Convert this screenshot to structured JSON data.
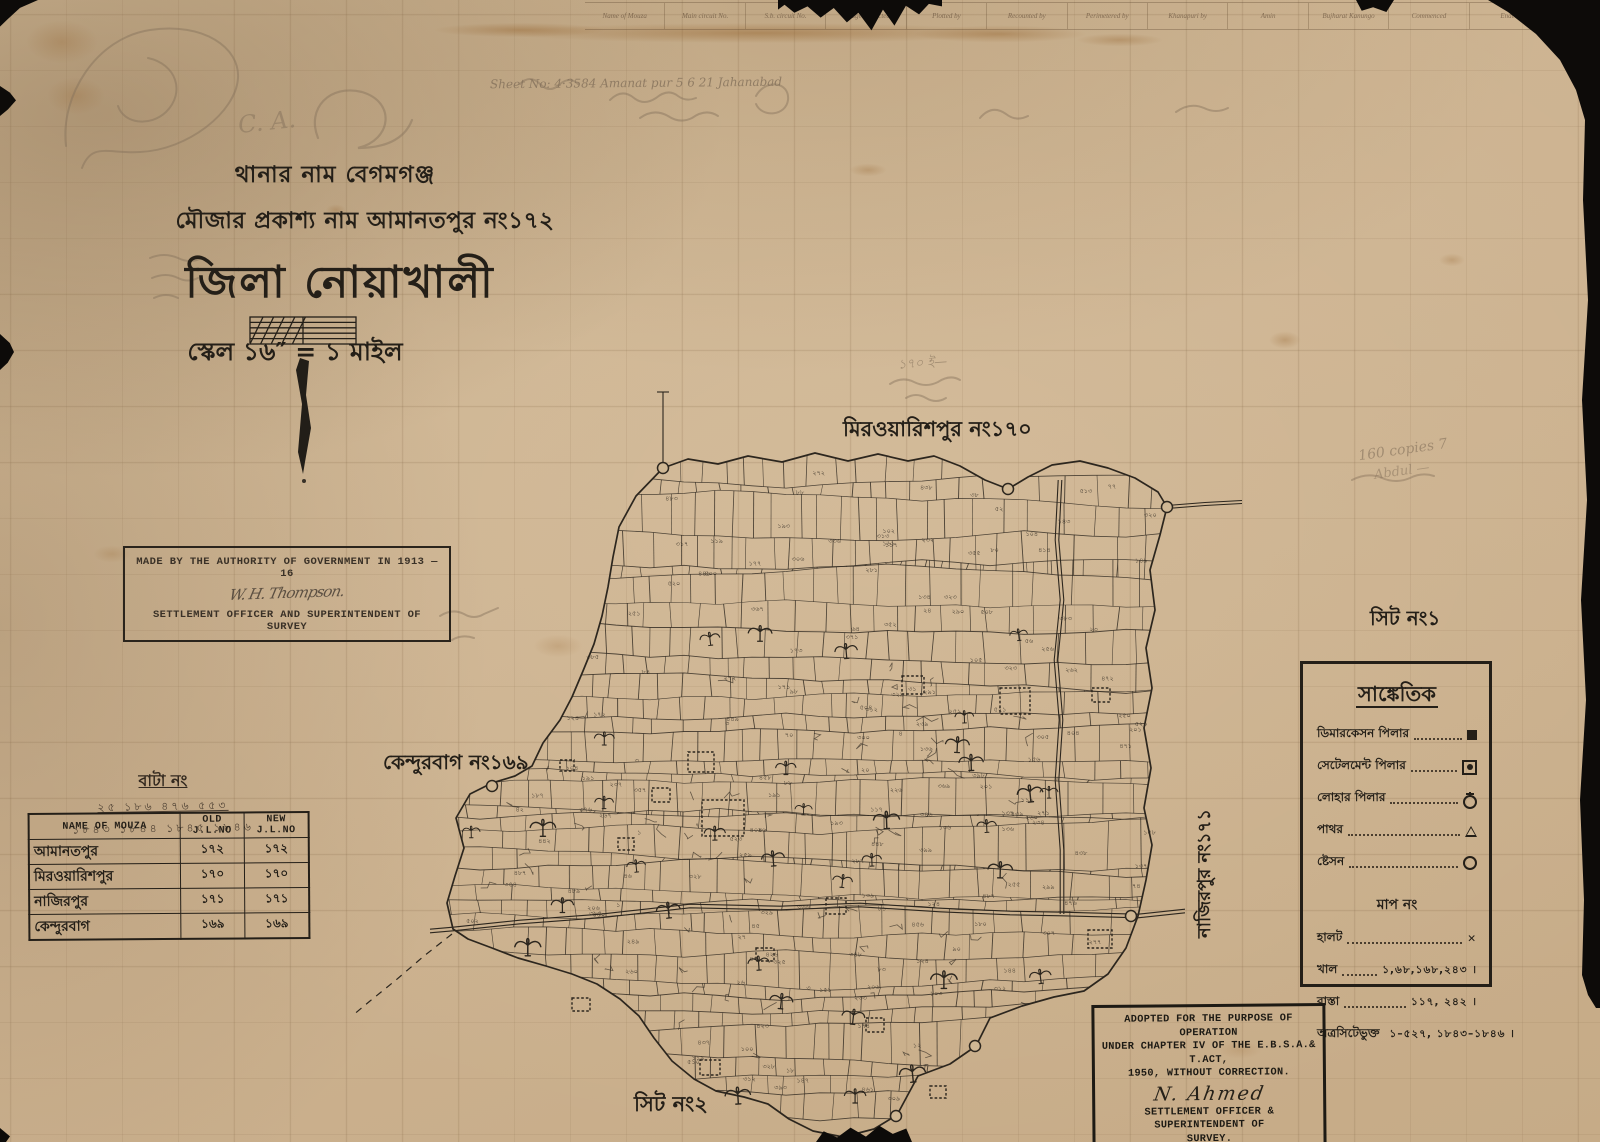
{
  "header_strip": {
    "columns": [
      "Name of Mouza",
      "Main circuit No.",
      "S.b. circuit No.",
      "Village inspected",
      "Plotted by",
      "Recounted by",
      "Perimetered by",
      "Khanapuri by",
      "Amin",
      "Bujharat Kanungo",
      "Commenced",
      "Ended"
    ]
  },
  "title_block": {
    "line1": "থানার নাম বেগমগঞ্জ",
    "line2": "মৌজার প্রকাশ্য নাম আমানতপুর নং১৭২",
    "line3": "জিলা নোয়াখালী",
    "line4": "স্কেল ১৬″ = ১ মাইল"
  },
  "authority_box": {
    "line1": "MADE BY THE AUTHORITY OF GOVERNMENT IN 1913 — 16",
    "signature": "W. H. Thompson.",
    "line2": "SETTLEMENT OFFICER AND SUPERINTENDENT OF SURVEY"
  },
  "bata_block": {
    "title": "বাটা নং",
    "row1": "২৫  ১৮৬  ৪৭৬  ৫৫৩",
    "row2": "১৮৪৩ ১৮৪৪ ১৮৪৫ ১৮৪৬"
  },
  "mouza_table": {
    "headers": [
      "NAME OF MOUZA",
      "OLD J.L.NO",
      "NEW J.L.NO"
    ],
    "rows": [
      [
        "আমানতপুর",
        "১৭২",
        "১৭২"
      ],
      [
        "মিরওয়ারিশপুর",
        "১৭০",
        "১৭০"
      ],
      [
        "নাজিরপুর",
        "১৭১",
        "১৭১"
      ],
      [
        "কেন্দুরবাগ",
        "১৬৯",
        "১৬৯"
      ]
    ]
  },
  "map_labels": {
    "north_neighbor": "মিরওয়ারিশপুর নং১৭০",
    "west_neighbor": "কেন্দুরবাগ নং১৬৯",
    "east_neighbor": "নাজিরপুর নং১৭১",
    "sheet1": "সিট নং১",
    "sheet2": "সিট নং২"
  },
  "legend": {
    "title": "সাঙ্কেতিক",
    "pillar_rows": [
      {
        "label": "ডিমারকেসন পিলার",
        "symbol": "sq-filled"
      },
      {
        "label": "সেটেলমেন্ট পিলার",
        "symbol": "sq-dot"
      },
      {
        "label": "লোহার পিলার",
        "symbol": "circle-cross"
      },
      {
        "label": "পাথর",
        "symbol": "triangle"
      },
      {
        "label": "ষ্টেসন",
        "symbol": "circle"
      }
    ],
    "subtitle": "মাপ নং",
    "number_rows": [
      {
        "label": "হালট",
        "value": "✕"
      },
      {
        "label": "খাল",
        "value": "১,৬৮,১৬৮,২৪৩ ।"
      },
      {
        "label": "রাস্তা",
        "value": "১১৭, ২৪২ ।"
      },
      {
        "label": "অত্রসিটেভুক্ত",
        "value": "১–৫২৭, ১৮৪৩–১৮৪৬ ।"
      }
    ]
  },
  "stamp": {
    "line1": "ADOPTED FOR THE PURPOSE OF OPERATION",
    "line2": "UNDER CHAPTER IV OF THE E.B.S.A.& T.ACT,",
    "line3": "1950, WITHOUT CORRECTION.",
    "signature": "N. Ahmed",
    "line4": "SETTLEMENT OFFICER & SUPERINTENDENT OF",
    "line5": "SURVEY."
  },
  "pencil_annotations": [
    {
      "text": "Sheet No:   4·3584    Amanat pur          5              6            21       Jahanabad",
      "x": 490,
      "y": 76,
      "size": 12,
      "rot": -0.5,
      "op": 0.8
    },
    {
      "text": "C. A.",
      "x": 238,
      "y": 108,
      "size": 24,
      "rot": -6,
      "op": 0.5
    },
    {
      "text": "১৭০ ই—",
      "x": 898,
      "y": 354,
      "size": 13,
      "rot": -4,
      "op": 0.6
    },
    {
      "text": "160 copies 7",
      "x": 1358,
      "y": 442,
      "size": 14,
      "rot": -8,
      "op": 0.6
    },
    {
      "text": "Abdul —",
      "x": 1374,
      "y": 464,
      "size": 13,
      "rot": -8,
      "op": 0.5
    }
  ],
  "colors": {
    "paper": "#cfb794",
    "ink": "#2c261e",
    "pencil": "#84715b",
    "stamp_ink": "#1d1a14"
  },
  "map_render": {
    "seed": 7,
    "boundary": [
      [
        663,
        468
      ],
      [
        688,
        459
      ],
      [
        718,
        464
      ],
      [
        748,
        456
      ],
      [
        782,
        462
      ],
      [
        815,
        453
      ],
      [
        848,
        461
      ],
      [
        878,
        454
      ],
      [
        908,
        461
      ],
      [
        934,
        456
      ],
      [
        960,
        466
      ],
      [
        985,
        480
      ],
      [
        1008,
        489
      ],
      [
        1028,
        477
      ],
      [
        1052,
        465
      ],
      [
        1080,
        461
      ],
      [
        1108,
        468
      ],
      [
        1135,
        478
      ],
      [
        1158,
        492
      ],
      [
        1167,
        507
      ],
      [
        1160,
        535
      ],
      [
        1150,
        570
      ],
      [
        1155,
        610
      ],
      [
        1146,
        648
      ],
      [
        1152,
        688
      ],
      [
        1144,
        728
      ],
      [
        1151,
        768
      ],
      [
        1144,
        808
      ],
      [
        1152,
        845
      ],
      [
        1146,
        880
      ],
      [
        1138,
        916
      ],
      [
        1126,
        948
      ],
      [
        1108,
        974
      ],
      [
        1084,
        991
      ],
      [
        1054,
        997
      ],
      [
        1022,
        1006
      ],
      [
        990,
        1018
      ],
      [
        976,
        1046
      ],
      [
        950,
        1064
      ],
      [
        918,
        1076
      ],
      [
        897,
        1115
      ],
      [
        874,
        1129
      ],
      [
        843,
        1137
      ],
      [
        813,
        1131
      ],
      [
        789,
        1119
      ],
      [
        768,
        1104
      ],
      [
        744,
        1097
      ],
      [
        716,
        1091
      ],
      [
        694,
        1079
      ],
      [
        672,
        1061
      ],
      [
        654,
        1038
      ],
      [
        639,
        1016
      ],
      [
        620,
        999
      ],
      [
        597,
        984
      ],
      [
        572,
        974
      ],
      [
        546,
        966
      ],
      [
        518,
        958
      ],
      [
        492,
        948
      ],
      [
        468,
        939
      ],
      [
        453,
        929
      ],
      [
        447,
        903
      ],
      [
        455,
        876
      ],
      [
        464,
        848
      ],
      [
        456,
        818
      ],
      [
        470,
        794
      ],
      [
        492,
        783
      ],
      [
        515,
        776
      ],
      [
        532,
        766
      ],
      [
        543,
        743
      ],
      [
        560,
        720
      ],
      [
        572,
        697
      ],
      [
        583,
        671
      ],
      [
        594,
        644
      ],
      [
        602,
        616
      ],
      [
        608,
        587
      ],
      [
        613,
        557
      ],
      [
        619,
        527
      ],
      [
        636,
        496
      ]
    ],
    "stations": [
      [
        663,
        468
      ],
      [
        1008,
        489
      ],
      [
        1167,
        507
      ],
      [
        492,
        786
      ],
      [
        1131,
        916
      ],
      [
        975,
        1046
      ],
      [
        896,
        1116
      ]
    ],
    "roads": {
      "main": [
        [
          430,
          931
        ],
        [
          453,
          929
        ],
        [
          520,
          922
        ],
        [
          600,
          916
        ],
        [
          690,
          906
        ],
        [
          780,
          908
        ],
        [
          860,
          905
        ],
        [
          940,
          910
        ],
        [
          1010,
          913
        ],
        [
          1062,
          914
        ],
        [
          1100,
          915
        ],
        [
          1138,
          916
        ],
        [
          1185,
          911
        ]
      ],
      "vertical": [
        [
          1060,
          480
        ],
        [
          1057,
          540
        ],
        [
          1062,
          600
        ],
        [
          1056,
          660
        ],
        [
          1061,
          720
        ],
        [
          1057,
          780
        ],
        [
          1062,
          850
        ],
        [
          1062,
          914
        ]
      ],
      "north_east": [
        [
          1167,
          507
        ],
        [
          1205,
          504
        ],
        [
          1242,
          502
        ]
      ]
    },
    "dashed_sw": [
      [
        452,
        934
      ],
      [
        424,
        956
      ],
      [
        396,
        980
      ],
      [
        370,
        1001
      ],
      [
        352,
        1016
      ]
    ],
    "north_tick": [
      [
        663,
        468
      ],
      [
        663,
        392
      ]
    ],
    "tanks": [
      [
        688,
        752,
        26,
        20
      ],
      [
        652,
        788,
        18,
        14
      ],
      [
        826,
        898,
        20,
        16
      ],
      [
        902,
        676,
        22,
        18
      ],
      [
        1000,
        688,
        30,
        26
      ],
      [
        1088,
        930,
        24,
        18
      ],
      [
        866,
        1018,
        18,
        14
      ],
      [
        930,
        1086,
        16,
        12
      ],
      [
        572,
        998,
        18,
        13
      ],
      [
        618,
        838,
        16,
        12
      ],
      [
        756,
        948,
        18,
        13
      ],
      [
        1092,
        688,
        18,
        14
      ],
      [
        702,
        800,
        42,
        36
      ],
      [
        560,
        760,
        14,
        11
      ],
      [
        700,
        1060,
        20,
        15
      ]
    ],
    "texture": {
      "x0": 446,
      "x1": 1166,
      "y0": 452,
      "y1": 1134,
      "hmin": 17,
      "hmax": 30,
      "vmin": 20,
      "vmax": 46
    },
    "plot_count": 175,
    "tree_count": 34,
    "stains": [
      [
        760,
        33,
        360,
        14,
        0.45
      ],
      [
        520,
        30,
        120,
        10,
        0.4
      ],
      [
        1000,
        34,
        120,
        12,
        0.4
      ],
      [
        1120,
        40,
        60,
        9,
        0.32
      ],
      [
        868,
        170,
        26,
        9,
        0.28
      ],
      [
        1285,
        340,
        22,
        12,
        0.3
      ],
      [
        1452,
        260,
        18,
        9,
        0.26
      ],
      [
        558,
        646,
        34,
        16,
        0.2
      ],
      [
        112,
        554,
        26,
        12,
        0.2
      ],
      [
        336,
        210,
        14,
        8,
        0.26
      ],
      [
        1240,
        1050,
        30,
        12,
        0.16
      ],
      [
        76,
        96,
        40,
        26,
        0.22
      ],
      [
        62,
        42,
        50,
        30,
        0.26
      ]
    ]
  }
}
